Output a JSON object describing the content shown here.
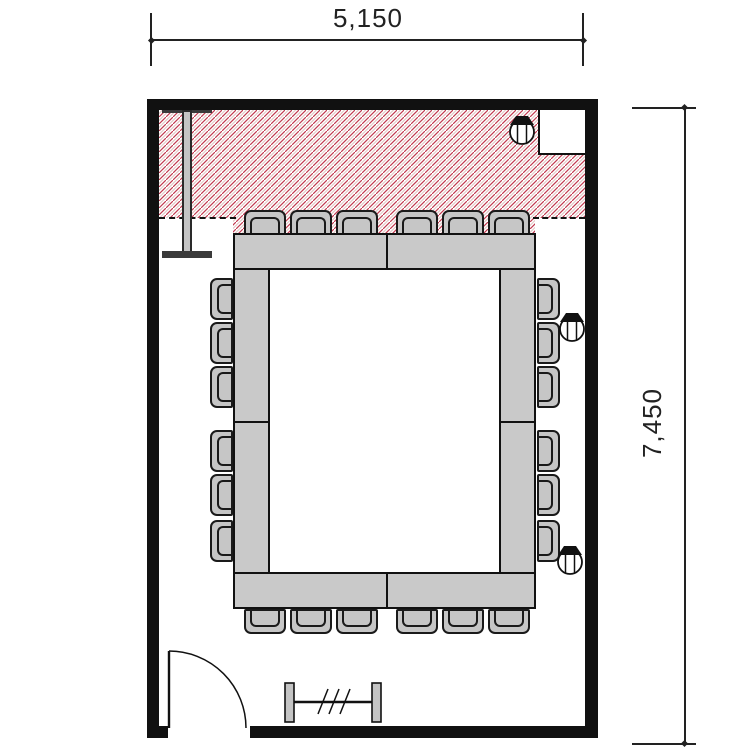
{
  "document": {
    "type": "architectural floor plan",
    "room": "meeting room with boardroom table layout"
  },
  "dimensions": {
    "top": {
      "label": "5,150"
    },
    "right": {
      "label": "7,450"
    }
  },
  "room": {
    "hatch_zone": "red diagonal hatched clearance zone along top wall",
    "corner_notch": "service shaft recess in top-right corner",
    "door": "single swing door at bottom-left",
    "screen_stand": "screen / whiteboard stand on left wall",
    "coat_rack": "coat rack at bottom center"
  },
  "furniture": {
    "table_layout": "closed hollow-rectangle conference table",
    "chairs_total": 24,
    "chairs_top": 6,
    "chairs_bottom": 6,
    "chairs_left": 6,
    "chairs_right": 6,
    "outlet_symbols": 3
  },
  "colors": {
    "wall": "#111111",
    "furniture_fill": "#c9c9c9",
    "hatch_red": "#c23a50"
  }
}
